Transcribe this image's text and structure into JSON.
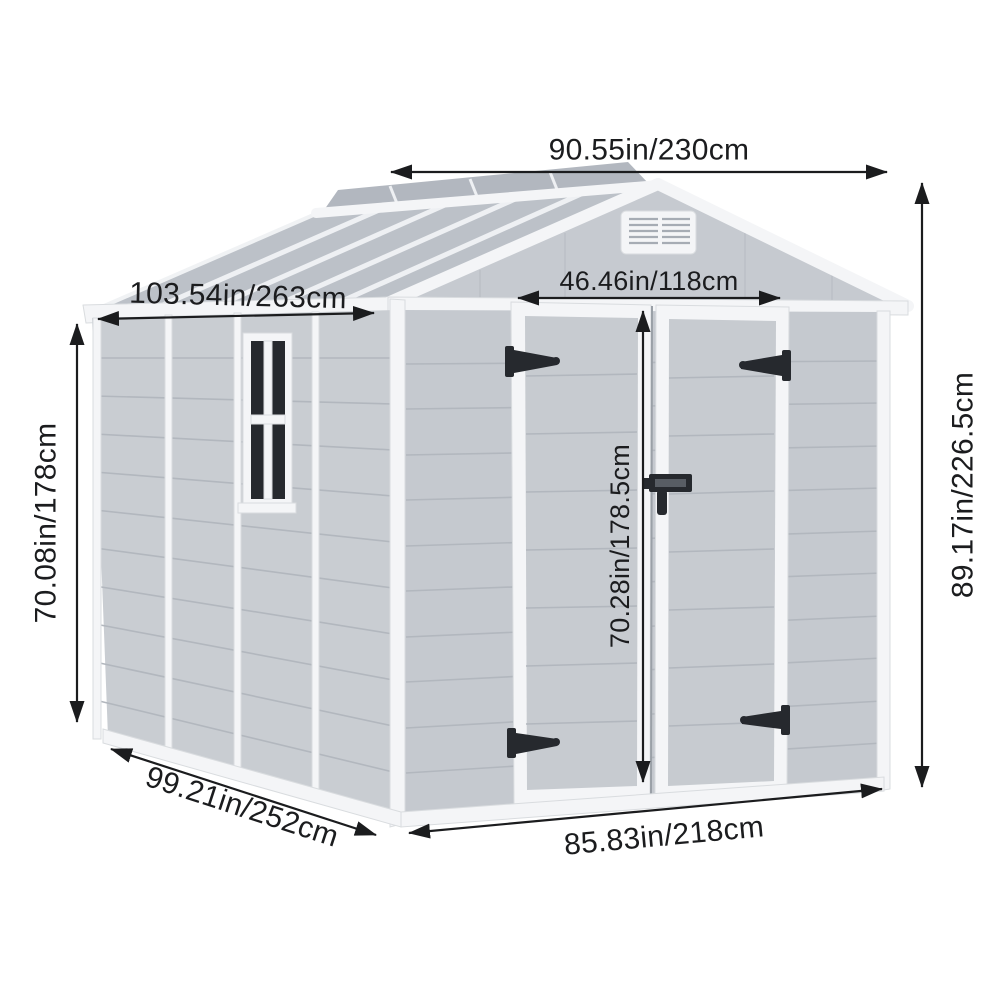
{
  "dims": {
    "roof_width": "90.55in/230cm",
    "roof_slope_depth": "103.54in/263cm",
    "door_width": "46.46in/118cm",
    "wall_height": "70.08in/178cm",
    "door_height": "70.28in/178.5cm",
    "overall_height": "89.17in/226.5cm",
    "base_depth": "99.21in/252cm",
    "base_width": "85.83in/218cm"
  },
  "colors": {
    "bg": "#ffffff",
    "dim": "#1b1c1e",
    "roof": "#bcc1c8",
    "roof_far": "#b2b7bf",
    "wall_side": "#c9cdd2",
    "wall_front": "#c5c9cf",
    "gable": "#c6cad0",
    "door_panel": "#c7cbd0",
    "trim": "#f4f5f7",
    "trim_edge": "#d9dcdf",
    "siding_line": "#b2b7be",
    "hardware": "#26292e",
    "glass": "#26292e"
  }
}
